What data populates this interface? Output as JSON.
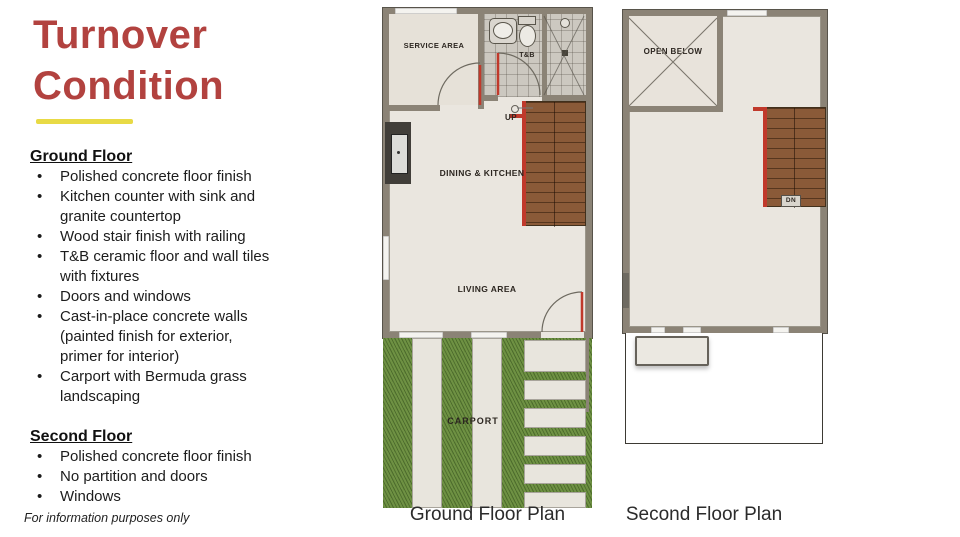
{
  "colors": {
    "accent_red": "#b2423f",
    "accent_yellow": "#e8da45",
    "wall_gray": "#8b8376",
    "floor_beige": "#eae6df",
    "tile_gray": "#ccc8c0",
    "stair_brown": "#8a5a38",
    "rail_red": "#c0392b",
    "grass_green": "#6f9144"
  },
  "slide": {
    "title_line1": "Turnover",
    "title_line2": "Condition",
    "footer": "For information purposes only"
  },
  "sections": {
    "ground": {
      "heading": "Ground Floor",
      "items": [
        "Polished concrete floor finish",
        "Kitchen counter with sink and\ngranite countertop",
        "Wood stair finish with railing",
        "T&B ceramic floor and wall tiles\nwith fixtures",
        "Doors and windows",
        "Cast-in-place concrete walls\n(painted finish for exterior,\nprimer for interior)",
        "Carport with Bermuda grass\nlandscaping"
      ]
    },
    "second": {
      "heading": "Second Floor",
      "items": [
        "Polished concrete floor finish",
        "No partition and doors",
        "Windows"
      ]
    }
  },
  "ground_plan": {
    "caption": "Ground Floor Plan",
    "labels": {
      "service_area": "SERVICE AREA",
      "tnb": "T&B",
      "up": "UP",
      "dining_kitchen": "DINING & KITCHEN",
      "living_area": "LIVING AREA",
      "carport": "CARPORT"
    }
  },
  "second_plan": {
    "caption": "Second Floor Plan",
    "labels": {
      "open_below": "OPEN BELOW",
      "dn": "DN"
    }
  }
}
